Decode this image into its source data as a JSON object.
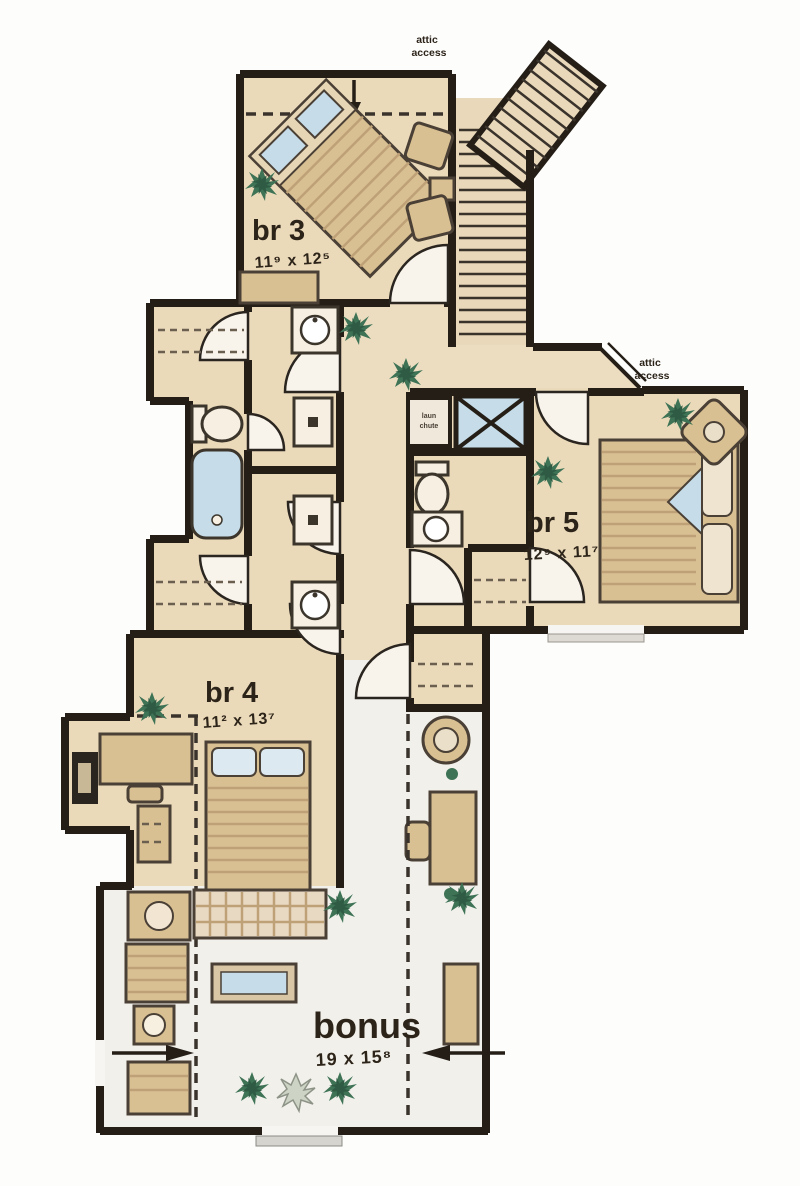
{
  "plan": {
    "type": "second-floor-plan",
    "rooms": {
      "br3": {
        "label": "br 3",
        "dims": "11⁹ x 12⁵"
      },
      "br5": {
        "label": "br 5",
        "dims": "12⁹ x 11⁷"
      },
      "br4": {
        "label": "br 4",
        "dims": "11² x 13⁷"
      },
      "bonus": {
        "label": "bonus",
        "dims": "19 x 15⁸"
      }
    },
    "annotations": {
      "attic_top": {
        "line1": "attic",
        "line2": "access"
      },
      "attic_right": {
        "line1": "attic",
        "line2": "access"
      },
      "chute": {
        "line1": "laun",
        "line2": "chute"
      }
    },
    "colors": {
      "wall": "#241e17",
      "floor_tan": "#ebdaba",
      "floor_bonus": "#f1f0ea",
      "furniture_tan": "#d9c092",
      "water_blue": "#c6dde9",
      "plant_green": "#3e7356",
      "text": "#2d2419"
    }
  }
}
